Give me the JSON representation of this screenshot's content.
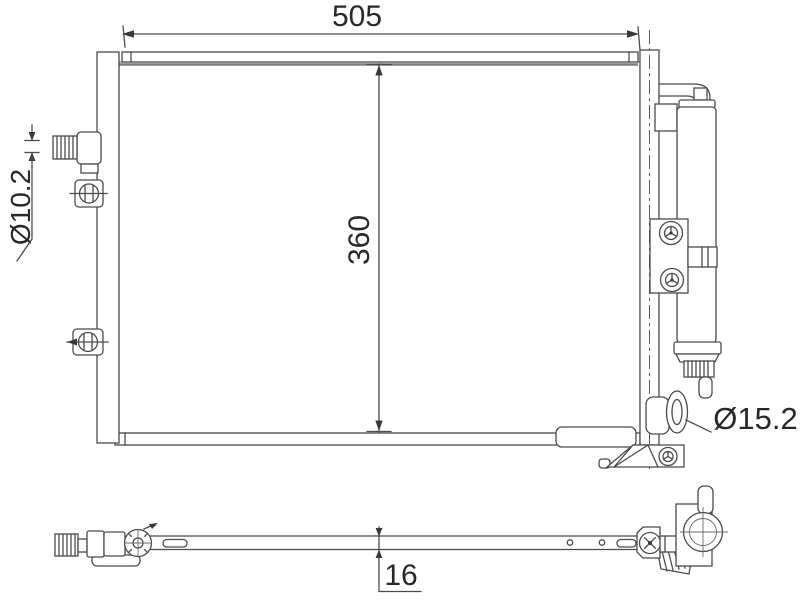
{
  "drawing": {
    "background_color": "#ffffff",
    "line_color": "#4b4b4e",
    "text_color": "#28282a",
    "dimensions": {
      "width": "505",
      "height": "360",
      "small_port_diameter": "Ø10.2",
      "large_port_diameter": "Ø15.2",
      "depth": "16"
    }
  }
}
